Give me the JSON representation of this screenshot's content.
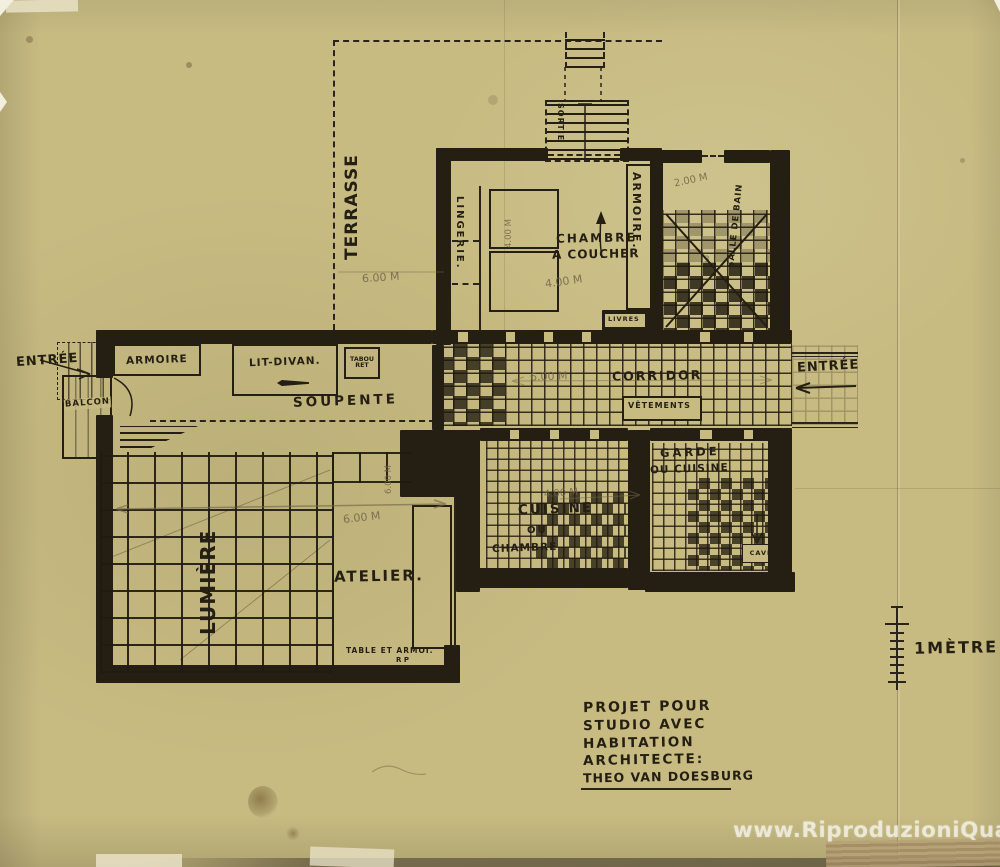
{
  "artwork": {
    "type": "architectural floor plan, ink on aged paper",
    "colors": {
      "paper": "#c7bb82",
      "ink": "#241e13",
      "pencil": "#70654a",
      "watermark": "#ffffff"
    },
    "labels": {
      "terrasse": "TERRASSE",
      "sortie": "SORTIE",
      "lingerie": "LINGERIE.",
      "chambre_line1": "CHAMBRE",
      "chambre_line2": "A COUCHER",
      "armoire_right": "ARMOIRE.",
      "salle_de_bain": "SALLE DE BAIN",
      "livres": "LIVRES",
      "entree_left": "ENTRÉE",
      "balcon": "BALCON",
      "armoire_left": "ARMOIRE",
      "lit_divan": "LIT-DIVAN.",
      "tabouret_line1": "TABOU",
      "tabouret_line2": "RET",
      "soupente": "SOUPENTE",
      "corridor": "CORRIDOR",
      "vetements": "VÊTEMENTS",
      "entree_right": "ENTRÉE",
      "cuisine_line1": "CUISINE",
      "cuisine_line2": "OU",
      "cuisine_line3": "CHAMBRE",
      "garde_line1": "GARDE",
      "garde_line2": "OU CUISINE",
      "cave": "CAVE",
      "lumiere": "LUMIÈRE",
      "atelier": "ATELIER.",
      "table_line1": "TABLE ET ARMOI.",
      "table_line2": "R P"
    },
    "pencil_annotations": {
      "terrasse_width": "6.00 M",
      "chambre_width": "4.00 M",
      "chambre_depth": "4.00 M",
      "bain_width": "2.00 M",
      "bain_number": "3",
      "corridor_length": "6.00 M",
      "atelier_width": "6.00 M",
      "atelier_depth": "6.00 M",
      "cuisine_width": "4.00 M"
    },
    "scale": {
      "label": "1MÈTRE"
    },
    "title_block": {
      "lines": [
        "PROJET POUR",
        "STUDIO AVEC",
        "HABITATION",
        "ARCHITECTE:",
        "THEO VAN DOESBURG"
      ]
    },
    "watermark": "www.RiproduzioniQuadri.it"
  }
}
